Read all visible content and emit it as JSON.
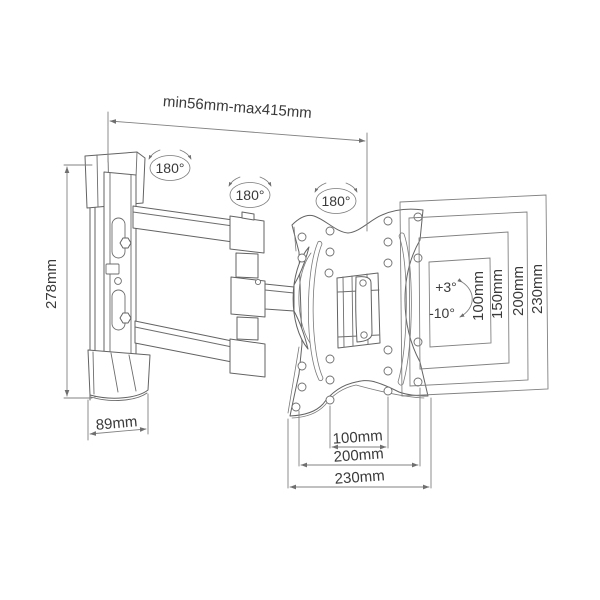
{
  "drawing": {
    "subject": "articulating-tv-wall-mount-technical-drawing",
    "view": "isometric line art with dimension annotations"
  },
  "labels": {
    "extension_range": "min56mm-max415mm",
    "wall_plate_height": "278mm",
    "wall_plate_width": "89mm",
    "bottom_hole_spacing_inner": "100mm",
    "bottom_hole_spacing_outer": "200mm",
    "bottom_plate_width": "230mm",
    "side_hole_spacing_1": "100mm",
    "side_hole_spacing_2": "150mm",
    "side_hole_spacing_3": "200mm",
    "side_plate_height": "230mm",
    "swivel_wall": "180°",
    "swivel_elbow": "180°",
    "swivel_plate": "180°",
    "tilt_up": "+3°",
    "tilt_down": "-10°"
  },
  "colors": {
    "line": "#666666",
    "dimension_line": "#828282",
    "text": "#3a3a3a",
    "background": "#ffffff"
  }
}
